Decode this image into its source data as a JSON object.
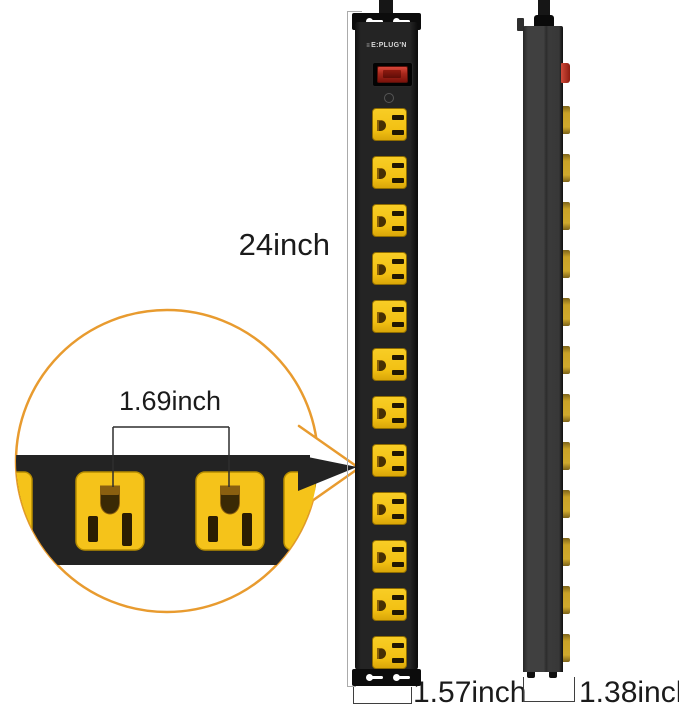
{
  "dimensions": {
    "length_label": "24inch",
    "outlet_spacing_label": "1.69inch",
    "front_width_label": "1.57inch",
    "side_depth_label": "1.38inch"
  },
  "brand": {
    "mark": "≡",
    "logo_text": "E:PLUG'N"
  },
  "front_view": {
    "outlet_count": 12,
    "first_outlet_top": 108,
    "outlet_pitch": 48
  },
  "side_view": {
    "outlet_edge_count": 12,
    "first_tab_top": 106,
    "tab_pitch": 48
  },
  "colors": {
    "outlet_yellow": "#F5C31A",
    "strip_black": "#232323",
    "callout_orange": "#E89B2F",
    "switch_red": "#B5271A",
    "dimension_line_gray": "#ABABAB",
    "text_dark": "#1B1B1B"
  }
}
